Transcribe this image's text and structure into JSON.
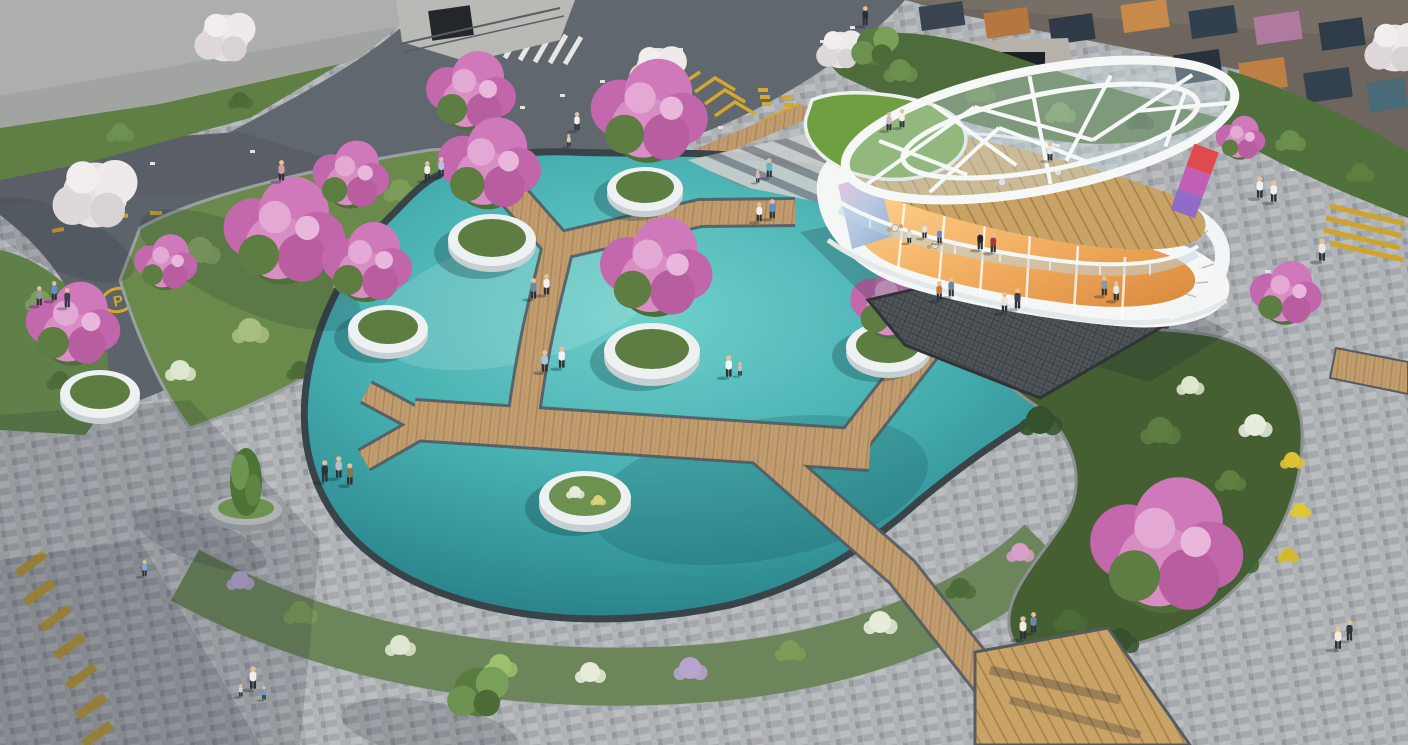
{
  "scene": {
    "type": "architectural-aerial-rendering",
    "title": "Residential plaza with circular pond, zigzag boardwalk and two-storey cafe pavilion",
    "view": "aerial-oblique",
    "time_of_day": "day"
  },
  "palette": {
    "water_light": "#6fd0cb",
    "water_mid": "#49b1b2",
    "water_deep": "#27727c",
    "boardwalk_wood": "#c19c6e",
    "deck_wood": "#c9a265",
    "paver": "#b6b9bc",
    "asphalt": "#61676e",
    "planter_white": "#edf1f2",
    "foliage_green": "#5d7c42",
    "foliage_dark": "#3b5530",
    "blossom_pink": "#cf79bb",
    "blossom_white": "#e7e2e2",
    "flower_yellow": "#ddc234",
    "flower_purple": "#b7a4cf",
    "pavilion_white": "#f5f7f7",
    "pavilion_glass": "#cfe0e4",
    "interior_glow": "#f0a95c",
    "roof_lawn": "#6f9f40",
    "marking_yellow": "#d4a82c",
    "marking_white": "#e8e8e8"
  },
  "pond": {
    "shape": "organic circle with north-east arm",
    "floating_planters": 6,
    "shore_planters": 1,
    "low_planter_contents": "grasses with white and yellow flowers"
  },
  "boardwalk": {
    "material": "timber planks",
    "layout": "zigzag branching across pond",
    "segments": 8
  },
  "pavilion": {
    "floors": 2,
    "roof": [
      "white lattice canopy",
      "green lawn roof"
    ],
    "ground_floor": "glass cafe with warm lit interior and art mural wall",
    "upper_floor": "open-air timber cafe terrace with glass railing",
    "features": [
      "curved white stair",
      "dark grating waterfront terrace",
      "striped shore paving"
    ],
    "cafe_tables": 6
  },
  "roads": {
    "p_symbol": "P",
    "markings": [
      "yellow P parking roundel",
      "yellow dashes",
      "yellow chevron zone with painted characters",
      "white dotted lane studs",
      "white crosswalk",
      "yellow crosswalk",
      "timber road crossing",
      "yellow edge hatching"
    ],
    "crosswalks": 3
  },
  "vegetation": {
    "crape_myrtle_pink_trees": 14,
    "white_blossom_trees": 5,
    "conifers": 1,
    "green_trees": 2,
    "beds": [
      "north-west mixed bed",
      "south crescent flower bed",
      "east shrub bed with pink, yellow and white flowers"
    ]
  },
  "people": {
    "figures": 47,
    "activities": [
      "walking",
      "talking",
      "sitting at cafe tables",
      "pointing at water",
      "piggyback ride",
      "child play",
      "skateboarding"
    ]
  }
}
